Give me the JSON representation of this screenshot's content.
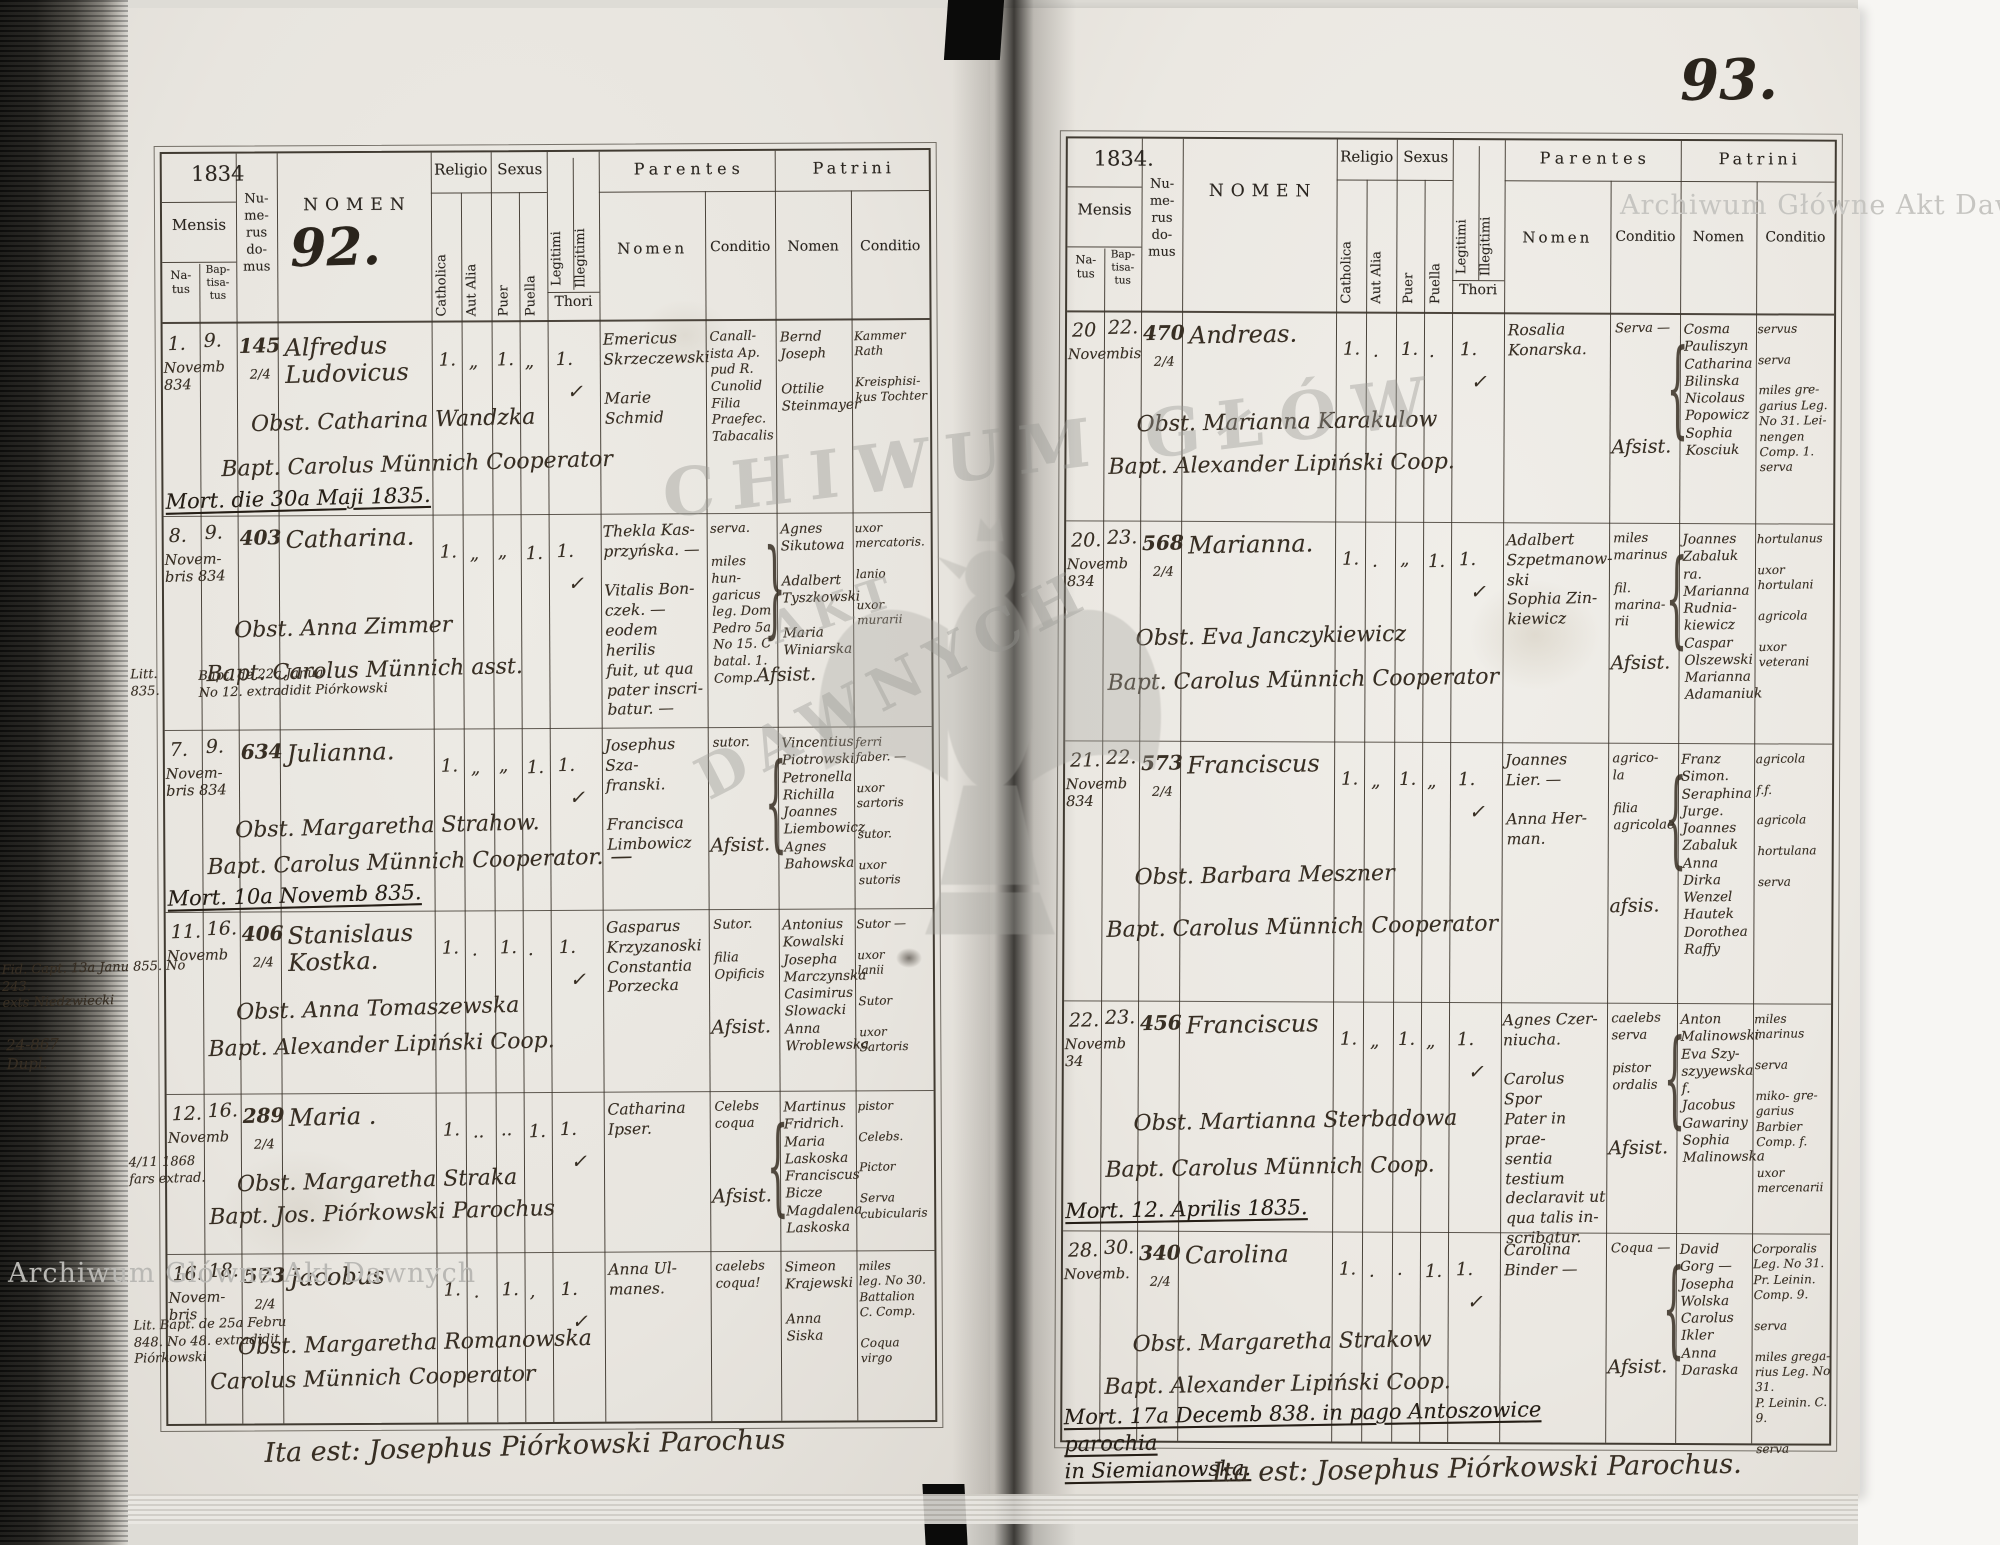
{
  "watermark": {
    "label": "Archiwum Główne Akt Dawnych",
    "center_top": "CHIWUM GŁÓW",
    "center_mid": "AKT",
    "center_bottom": "DAWNYCH"
  },
  "header": {
    "mensis": "Mensis",
    "natus_h": "Na-\ntus",
    "baptisatus_h": "Bap-\ntisa-\ntus",
    "numerus_h": "Nu-\nme-\nrus\ndo-\nmus",
    "nomen_h": "NOMEN",
    "religio": "Religio",
    "catholica": "Catholica",
    "aut_alia": "Aut Alia",
    "sexus": "Sexus",
    "puer": "Puer",
    "puella": "Puella",
    "legitimi": "Legitimi",
    "illegitimi": "Illegitimi",
    "thori": "Thori",
    "parentes": "Parentes",
    "patrini": "Patrini",
    "nomen_sub": "Nomen",
    "conditio": "Conditio"
  },
  "left": {
    "year": "1834",
    "page_number": "92.",
    "footer": "Ita est: Josephus Piórkowski Parochus",
    "records": [
      {
        "natus": "1.",
        "bapt": "9.",
        "month": "Novemb\n834",
        "num": "145",
        "frac": "2/4",
        "name": "Alfredus\nLudovicus",
        "mc": "1.",
        "ma": "„",
        "mp": "1.",
        "mq": "„",
        "ml": "1.",
        "chk": "✓",
        "obst": "Obst. Catharina Wandzka",
        "baptline": "Bapt. Carolus Münnich Cooperator",
        "mort": "Mort. die 30a Maji 1835.",
        "pn": "Emericus\nSkrzeczewski\n\nMarie\nSchmid",
        "pc": "Canall-\nista Ap.\npud R.\nCunolid\nFilia\nPraefec.\nTabacalis",
        "tn": "Bernd\nJoseph\n\nOttilie\nSteinmayer",
        "tc": "Kammer\nRath\n\nKreisphisi-\nkus Tochter"
      },
      {
        "natus": "8.",
        "bapt": "9.",
        "month": "Novem-\nbris 834",
        "num": "403",
        "name": "Catharina.",
        "mc": "1.",
        "ma": "„",
        "mp": "„",
        "mq": "1.",
        "ml": "1.",
        "chk": "✓",
        "obst": "Obst. Anna Zimmer",
        "baptline": "Bapt. Carolus Münnich asst.",
        "margin1": "Litt.\n835.",
        "margin2": "Bapt. de 22a Janua\nNo 12. extradidit Piórkowski",
        "pn": "Thekla Kas-\nprzyńska. —\n\nVitalis Bon-\nczek. —\neodem herilis\nfuit, ut qua\npater inscri-\nbatur. —",
        "pc": "serva.\n\nmiles hun-\ngaricus\nleg. Dom\nPedro 5a\nNo 15. C\nbatal. 1.\nComp.",
        "tn": "Agnes\nSikutowa\n\nAdalbert\nTyszkowski\n\nMaria\nWiniarska",
        "tc": "uxor\nmercatoris.\n\nlanio\n\nuxor\nmurarii",
        "assist": "Afsist.",
        "brace": "}"
      },
      {
        "natus": "7.",
        "bapt": "9.",
        "month": "Novem-\nbris 834",
        "num": "634",
        "name": "Julianna.",
        "mc": "1.",
        "ma": "„",
        "mp": "„",
        "mq": "1.",
        "ml": "1.",
        "chk": "✓",
        "obst": "Obst. Margaretha Strahow.",
        "baptline": "Bapt. Carolus Münnich Cooperator. —",
        "mort": "Mort. 10a Novemb 835.",
        "pn": "Josephus Sza-\nfranski.\n\nFrancisca\nLimbowicz",
        "pc": "sutor.",
        "tn": "Vincentius\nPiotrowski\nPetronella\nRichilla\nJoannes\nLiembowicz\nAgnes\nBahowska",
        "tc": "ferri\nfaber. —\n\nuxor\nsartoris\n\nsutor.\n\nuxor\nsutoris",
        "assist": "Afsist.",
        "brace": "{"
      },
      {
        "natus": "11.",
        "bapt": "16.",
        "month": "Novemb",
        "num": "406",
        "frac": "2/4",
        "name": "Stanislaus\nKostka.",
        "mc": "1.",
        "ma": ".",
        "mp": "1.",
        "mq": ".",
        "ml": "1.",
        "chk": "✓",
        "obst": "Obst. Anna Tomaszewska",
        "baptline": "Bapt. Alexander Lipiński Coop.",
        "margin1": "24-867\nDupl.",
        "margin2": "Fid. Capt. 13a Janu 855. No 243.\nexts Niedzwiecki",
        "pn": "Gasparus\nKrzyzanoski\nConstantia\nPorzecka",
        "pc": "Sutor.\n\nfilia\nOpificis",
        "tn": "Antonius\nKowalski\nJosepha\nMarczynska\nCasimirus\nSlowacki\nAnna\nWroblewska",
        "tc": "Sutor —\n\nuxor\nlanii\n\nSutor\n\nuxor\nSartoris",
        "assist": "Afsist."
      },
      {
        "natus": "12.",
        "bapt": "16.",
        "month": "Novemb",
        "num": "289",
        "frac": "2/4",
        "name": "Maria .",
        "mc": "1.",
        "ma": "..",
        "mp": "..",
        "mq": "1.",
        "ml": "1.",
        "chk": "✓",
        "obst": "Obst. Margaretha Straka",
        "baptline": "Bapt. Jos. Piórkowski Parochus",
        "margin1": "4/11 1868\nfars extrad.",
        "pn": "Catharina\nIpser.",
        "pc": "Celebs\ncoqua",
        "tn": "Martinus\nFridrich.\nMaria\nLaskoska\nFranciscus\nBicze\nMagdalena\nLaskoska",
        "tc": "pistor\n\nCelebs.\n\nPictor\n\nServa\ncubicularis",
        "assist": "Afsist.",
        "brace": "{"
      },
      {
        "natus": "16.",
        "bapt": "18.",
        "month": "Novem-\nbris",
        "num": "573",
        "frac": "2/4",
        "name": "Jacobus",
        "mc": "1.",
        "ma": ".",
        "mp": "1.",
        "mq": ",",
        "ml": "1.",
        "chk": "✓",
        "obst": "Obst. Margaretha Romanowska",
        "baptline": "Carolus Münnich Cooperator",
        "margin1": "Lit. Bapt. de 25a Febru\n848. No 48. extradidit\nPiórkowski",
        "pn": "Anna Ul-\nmanes.",
        "pc": "caelebs\ncoqua!",
        "tn": "Simeon\nKrajewski\n\nAnna\nSiska",
        "tc": "miles\nleg. No 30.\nBattalion\nC. Comp.\n\nCoqua\nvirgo"
      }
    ]
  },
  "right": {
    "year": "1834.",
    "page_number": "93.",
    "footer": "Ita est: Josephus Piórkowski Parochus.",
    "records": [
      {
        "natus": "20",
        "bapt": "22.",
        "month": "Novembis",
        "num": "470",
        "frac": "2/4",
        "name": "Andreas.",
        "mc": "1.",
        "ma": ".",
        "mp": "1.",
        "mq": ".",
        "ml": "1.",
        "chk": "✓",
        "obst": "Obst. Marianna Karakulow",
        "baptline": "Bapt. Alexander Lipiński Coop.",
        "pn": "Rosalia\nKonarska.",
        "pc": "Serva —",
        "tn": "Cosma\nPauliszyn\nCatharina\nBilinska\nNicolaus\nPopowicz\nSophia\nKosciuk",
        "tc": "servus\n\nserva\n\nmiles gre-\ngarius Leg.\nNo 31. Lei-\nnengen\nComp. 1.\nserva",
        "assist": "Afsist.",
        "brace": "{"
      },
      {
        "natus": "20.",
        "bapt": "23.",
        "month": "Novemb\n834",
        "num": "568",
        "frac": "2/4",
        "name": "Marianna.",
        "mc": "1.",
        "ma": ".",
        "mp": "„",
        "mq": "1.",
        "ml": "1.",
        "chk": "✓",
        "obst": "Obst. Eva Janczykiewicz",
        "baptline": "Bapt. Carolus Münnich Cooperator",
        "pn": "Adalbert\nSzpetmanow-\nski\nSophia Zin-\nkiewicz",
        "pc": "miles\nmarinus\n\nfil.\nmarina-\nrii",
        "tn": "Joannes\nZabaluk\nra.\nMarianna\nRudnia-\nkiewicz\nCaspar\nOlszewski\nMarianna\nAdamaniuk",
        "tc": "hortulanus\n\nuxor\nhortulani\n\nagricola\n\nuxor\nveterani",
        "assist": "Afsist.",
        "brace": "{"
      },
      {
        "natus": "21.",
        "bapt": "22.",
        "month": "Novemb\n834",
        "num": "573",
        "frac": "2/4",
        "name": "Franciscus",
        "mc": "1.",
        "ma": "„",
        "mp": "1.",
        "mq": "„",
        "ml": "1.",
        "chk": "✓",
        "obst": "Obst. Barbara Meszner",
        "baptline": "Bapt. Carolus Münnich Cooperator",
        "pn": "Joannes\nLier. —\n\nAnna Her-\nman.",
        "pc": "agrico-\nla\n\nfilia\nagricolae",
        "tn": "Franz\nSimon.\nSeraphina\nJurge.\nJoannes\nZabaluk\nAnna\nDirka\nWenzel\nHautek\nDorothea\nRaffy",
        "tc": "agricola\n\nf.f.\n\nagricola\n\nhortulana\n\nserva",
        "assist": "afsis.",
        "brace": "{"
      },
      {
        "natus": "22.",
        "bapt": "23.",
        "month": "Novemb\n34",
        "num": "456",
        "name": "Franciscus",
        "mc": "1.",
        "ma": "„",
        "mp": "1.",
        "mq": "„",
        "ml": "1.",
        "chk": "✓",
        "obst": "Obst. Martianna Sterbadowa",
        "baptline": "Bapt. Carolus Münnich Coop.",
        "mort": "Mort. 12. Aprilis 1835.",
        "pn": "Agnes Czer-\nniucha.\n\nCarolus Spor\nPater in prae-\nsentia testium\ndeclaravit ut\nqua talis in-\nscribatur.",
        "pc": "caelebs\nserva\n\npistor\nordalis",
        "tn": "Anton\nMalinowski\nEva Szy-\nszyyewska f.\nJacobus\nGawariny\nSophia\nMalinowska",
        "tc": "miles\nmarinus\n\nserva\n\nmiko- gre-\ngarius Barbier\nComp. f.\n\nuxor\nmercenarii",
        "assist": "Afsist.",
        "brace": "{"
      },
      {
        "natus": "28.",
        "bapt": "30.",
        "month": "Novemb.",
        "num": "340",
        "frac": "2/4",
        "name": "Carolina",
        "mc": "1.",
        "ma": ".",
        "mp": ".",
        "mq": "1.",
        "ml": "1.",
        "chk": "✓",
        "obst": "Obst. Margaretha Strakow",
        "baptline": "Bapt. Alexander Lipiński Coop.",
        "mort": "Mort. 17a Decemb 838. in pago Antoszowice parochia\nin Siemianowska.",
        "pn": "Carolina\nBinder —",
        "pc": "Coqua —",
        "tn": "David\nGorg —\nJosepha\nWolska\nCarolus\nIkler\nAnna\nDaraska",
        "tc": "Corporalis\nLeg. No 31.\nPr. Leinin.\nComp. 9.\n\nserva\n\nmiles grega-\nrius Leg. No 31.\nP. Leinin. C. 9.\n\nserva",
        "assist": "Afsist.",
        "brace": "{"
      }
    ]
  }
}
